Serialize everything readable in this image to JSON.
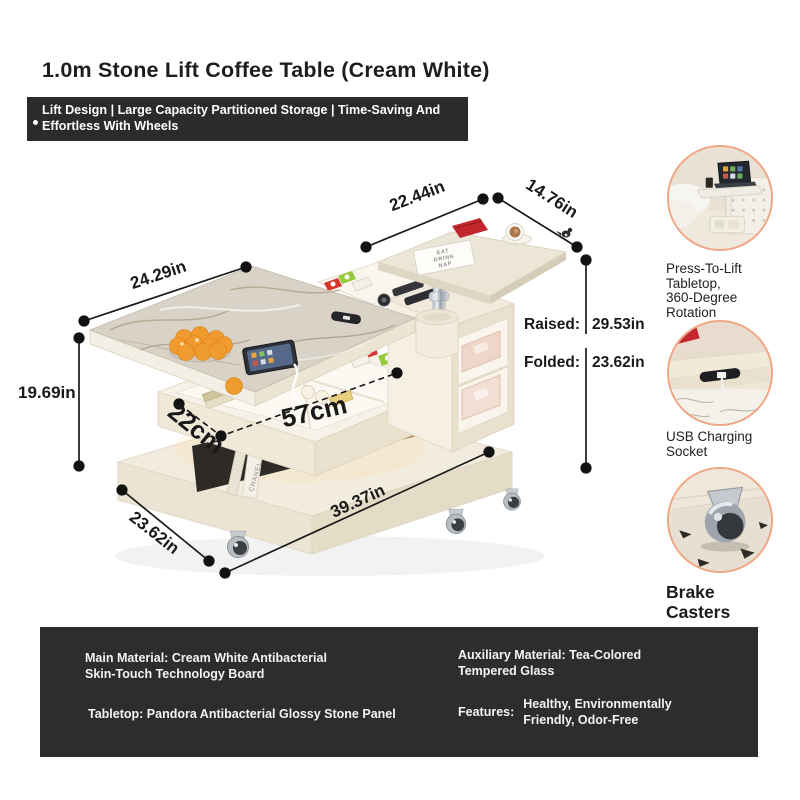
{
  "title": "1.0m Stone Lift Coffee Table (Cream White)",
  "banner": {
    "line1": "Lift Design | Large Capacity Partitioned Storage | Time-Saving And",
    "line2": "Effortless With Wheels",
    "bg_color": "#2b2b2b",
    "text_color": "#ffffff"
  },
  "diagram": {
    "dim_main_top_width": "24.29in",
    "dim_main_height": "19.69in",
    "dim_side_top_width": "22.44in",
    "dim_side_top_depth": "14.76in",
    "dim_drawer_depth": "22cm",
    "dim_drawer_width": "57cm",
    "dim_base_depth": "23.62in",
    "dim_base_width": "39.37in",
    "raised_label": "Raised:",
    "raised_value": "29.53in",
    "folded_label": "Folded:",
    "folded_value": "23.62in",
    "book_line1": "EAT",
    "book_line2": "DRINK",
    "book_line3": "NAP",
    "book_spine_text": "CHANEL",
    "annotation_color": "#191919"
  },
  "features": [
    {
      "lines": [
        "Press-To-Lift",
        "Tabletop,",
        "360-Degree",
        "Rotation"
      ]
    },
    {
      "lines": [
        "USB Charging",
        "Socket"
      ]
    },
    {
      "lines": [
        "Brake",
        "Casters"
      ]
    }
  ],
  "feature_ring_color": "#f0a584",
  "palette": {
    "cream": "#f2ecdf",
    "marble": "#d9d3c7",
    "accent_red": "#c1272d",
    "orange": "#f09b30",
    "green_box": "#96c93d",
    "spec_bg": "#2e2d2b"
  },
  "spec_panel": {
    "main_material_line1": "Main Material: Cream White Antibacterial",
    "main_material_line2": "Skin-Touch Technology Board",
    "tabletop": "Tabletop: Pandora Antibacterial Glossy Stone Panel",
    "auxiliary_line1": "Auxiliary Material: Tea-Colored",
    "auxiliary_line2": "Tempered Glass",
    "features_label": "Features:",
    "features_value_line1": "Healthy, Environmentally",
    "features_value_line2": "Friendly, Odor-Free"
  }
}
